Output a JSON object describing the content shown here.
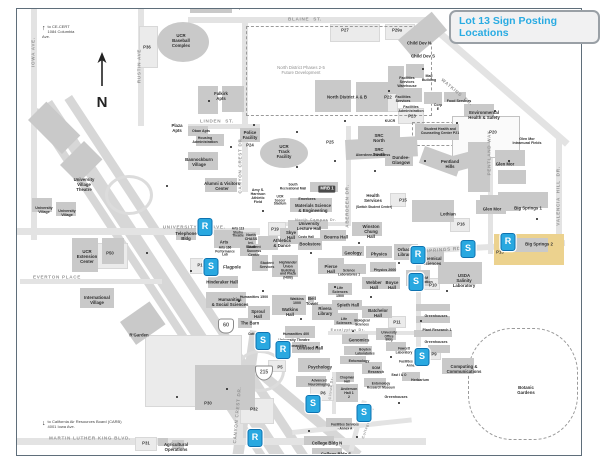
{
  "title": {
    "text": "Lot 13 Sign Posting Locations",
    "color": "#29abe2"
  },
  "map": {
    "marker_color": "#29a8e0",
    "highlight": {
      "label": "Big Springs 2",
      "color": "#ecd28e",
      "x": 494,
      "y": 234,
      "w": 70,
      "h": 31
    },
    "compass": {
      "label": "N"
    },
    "notes": [
      {
        "t": "to CE-CERT\n1084 Columbia Ave.",
        "x": 42,
        "y": 24,
        "arrow": "↑"
      },
      {
        "t": "to California Air Resources Board (CARB)\n4001 Iowa Ave.",
        "x": 42,
        "y": 419,
        "arrow": "↓"
      }
    ],
    "shields": [
      {
        "route": "60",
        "kind": "state",
        "x": 226,
        "y": 326
      },
      {
        "route": "215",
        "kind": "interstate",
        "x": 264,
        "y": 373
      }
    ],
    "streets": [
      {
        "t": "BLAINE  ST.",
        "x": 305,
        "y": 19
      },
      {
        "t": "LINDEN  ST.",
        "x": 217,
        "y": 121
      },
      {
        "t": "UNIVERSITY",
        "x": 180,
        "y": 227
      },
      {
        "t": "AVE.",
        "x": 219,
        "y": 227
      },
      {
        "t": "EVERTON PLACE",
        "x": 57,
        "y": 277
      },
      {
        "t": "MARTIN LUTHER KING BLVD.",
        "x": 90,
        "y": 438
      },
      {
        "t": "BIG SPRINGS RD",
        "x": 437,
        "y": 250,
        "rot": -4
      },
      {
        "t": "IOWA AVE.",
        "x": 33,
        "y": 52,
        "rot": -90
      },
      {
        "t": "RUSTIN AVE",
        "x": 139,
        "y": 66,
        "rot": -90
      },
      {
        "t": "CANYON CREST DR",
        "x": 240,
        "y": 166,
        "rot": -90
      },
      {
        "t": "CANYON CREST DR.",
        "x": 237,
        "y": 415,
        "rot": -85
      },
      {
        "t": "ABERDEEN DR.",
        "x": 347,
        "y": 206,
        "rot": -90
      },
      {
        "t": "WATKINS  DR.",
        "x": 457,
        "y": 92,
        "rot": 40
      },
      {
        "t": "PENTLAND WAY",
        "x": 489,
        "y": 153,
        "rot": -90
      },
      {
        "t": "VALENCIA  HILL  DR.",
        "x": 558,
        "y": 196,
        "rot": -90
      },
      {
        "t": "North Campus Dr.",
        "x": 316,
        "y": 220,
        "fs": 3.6
      },
      {
        "t": "Eucalyptus Dr.",
        "x": 348,
        "y": 330,
        "fs": 3.6
      },
      {
        "t": "Citrus Dr.",
        "x": 331,
        "y": 388,
        "rot": -85,
        "fs": 3.6
      },
      {
        "t": "College Place",
        "x": 368,
        "y": 423,
        "rot": -72,
        "fs": 3.6
      }
    ],
    "labels": [
      {
        "t": "Stonehaven Apts",
        "x": 228,
        "y": 8
      },
      {
        "t": "UCR\nBaseball\nComplex",
        "x": 181,
        "y": 41
      },
      {
        "t": "P36",
        "x": 147,
        "y": 48,
        "cls": "lot"
      },
      {
        "t": "Falkirk\nApts",
        "x": 221,
        "y": 97
      },
      {
        "t": "North District Phases 2-5\nFuture Development",
        "x": 301,
        "y": 71,
        "cls": "muted"
      },
      {
        "t": "North District A & B",
        "x": 347,
        "y": 98
      },
      {
        "t": "P27",
        "x": 345,
        "y": 31,
        "cls": "lot"
      },
      {
        "t": "P29a",
        "x": 397,
        "y": 31,
        "cls": "lot"
      },
      {
        "t": "P22",
        "x": 388,
        "y": 98,
        "cls": "lot"
      },
      {
        "t": "Child Dev N",
        "x": 419,
        "y": 44
      },
      {
        "t": "Child Dev S",
        "x": 423,
        "y": 57
      },
      {
        "t": "Facilities\nServices\nWarehouse",
        "x": 407,
        "y": 82,
        "fs": 3.6
      },
      {
        "t": "Mail\nBuilding",
        "x": 429,
        "y": 78,
        "fs": 3.6
      },
      {
        "t": "Facilities\nServices",
        "x": 403,
        "y": 99,
        "fs": 3.6
      },
      {
        "t": "Facilities\nAdministration",
        "x": 411,
        "y": 109,
        "fs": 3.6
      },
      {
        "t": "Corp\nE",
        "x": 438,
        "y": 107,
        "fs": 3.6
      },
      {
        "t": "Food Services",
        "x": 459,
        "y": 101,
        "fs": 3.6
      },
      {
        "t": "Environmental\nHealth & Safety",
        "x": 484,
        "y": 116
      },
      {
        "t": "KUCR",
        "x": 390,
        "y": 121,
        "fs": 3.6
      },
      {
        "t": "P23",
        "x": 412,
        "y": 117,
        "cls": "lot"
      },
      {
        "t": "Student Health and\nCounseling Center  P21",
        "x": 440,
        "y": 132,
        "fs": 3.5
      },
      {
        "t": "P20",
        "x": 493,
        "y": 133,
        "cls": "lot"
      },
      {
        "t": "Glen Mor\nIntramural Fields",
        "x": 527,
        "y": 141,
        "fs": 3.6
      },
      {
        "t": "Plaza\nApts",
        "x": 177,
        "y": 129
      },
      {
        "t": "Oban Apts",
        "x": 201,
        "y": 131,
        "fs": 3.6
      },
      {
        "t": "Housing\nAdministration",
        "x": 205,
        "y": 140,
        "fs": 3.6
      },
      {
        "t": "Bannockburn\nVillage",
        "x": 199,
        "y": 163
      },
      {
        "t": "Alumni & Visitors\nCenter",
        "x": 222,
        "y": 187
      },
      {
        "t": "University\nVillage\nTheatre",
        "x": 84,
        "y": 185
      },
      {
        "t": "University\nVillage",
        "x": 44,
        "y": 210,
        "fs": 3.6
      },
      {
        "t": "University\nVillage",
        "x": 67,
        "y": 213,
        "fs": 3.6
      },
      {
        "t": "Police\nFacility",
        "x": 250,
        "y": 136
      },
      {
        "t": "UCR\nTrack\nFacility",
        "x": 284,
        "y": 152
      },
      {
        "t": "P24",
        "x": 250,
        "y": 146,
        "cls": "lot"
      },
      {
        "t": "P25",
        "x": 330,
        "y": 143,
        "cls": "lot"
      },
      {
        "t": "P19",
        "x": 275,
        "y": 230,
        "cls": "lot"
      },
      {
        "t": "SRC\nNorth",
        "x": 379,
        "y": 139
      },
      {
        "t": "SRC\nSouth",
        "x": 379,
        "y": 153
      },
      {
        "t": "Aberdeen-Inverness",
        "x": 373,
        "y": 155,
        "fs": 3.6
      },
      {
        "t": "Dundee-\nGlasgow",
        "x": 401,
        "y": 161
      },
      {
        "t": "Pentland\nHills",
        "x": 450,
        "y": 165
      },
      {
        "t": "Glen Mor",
        "x": 505,
        "y": 165
      },
      {
        "t": "Glen Mor",
        "x": 492,
        "y": 210
      },
      {
        "t": "Big Springs 1",
        "x": 528,
        "y": 209
      },
      {
        "t": "Lothian",
        "x": 448,
        "y": 215
      },
      {
        "t": "P16",
        "x": 461,
        "y": 225,
        "cls": "lot"
      },
      {
        "t": "P15",
        "x": 403,
        "y": 201,
        "cls": "lot"
      },
      {
        "t": "Health\nServices",
        "x": 373,
        "y": 199
      },
      {
        "t": "(Switch Student Center)",
        "x": 374,
        "y": 208,
        "fs": 3.2
      },
      {
        "t": "Amy S.\nHarrison\nAthletic\nField",
        "x": 258,
        "y": 196,
        "fs": 3.6
      },
      {
        "t": "UCR\nSoccer\nStadium",
        "x": 280,
        "y": 201,
        "fs": 3.2
      },
      {
        "t": "South\nRecreational Mall",
        "x": 293,
        "y": 187,
        "fs": 3.2
      },
      {
        "t": "MRB 1",
        "x": 327,
        "y": 189,
        "cls": "chip"
      },
      {
        "t": "Emerbees",
        "x": 307,
        "y": 199,
        "fs": 3.6
      },
      {
        "t": "Materials Science\n& Engineering",
        "x": 313,
        "y": 209
      },
      {
        "t": "University\nLecture Hall",
        "x": 309,
        "y": 227
      },
      {
        "t": "Winston\nChung\nHall",
        "x": 371,
        "y": 232
      },
      {
        "t": "Bourns Hall",
        "x": 336,
        "y": 238
      },
      {
        "t": "Skye\nHall",
        "x": 291,
        "y": 236
      },
      {
        "t": "Costo Hall",
        "x": 306,
        "y": 238,
        "fs": 3.2
      },
      {
        "t": "Bookstore",
        "x": 310,
        "y": 245
      },
      {
        "t": "North\nCHASS\nInt.\nSouth",
        "x": 251,
        "y": 241,
        "fs": 3.6
      },
      {
        "t": "Athletics\n& Dance",
        "x": 282,
        "y": 244
      },
      {
        "t": "Student\nSuccess\nCenter",
        "x": 254,
        "y": 251,
        "fs": 3.6
      },
      {
        "t": "Student\nServices",
        "x": 267,
        "y": 265,
        "fs": 3.6
      },
      {
        "t": "Highlander\nUnion\nBuilding\nand Plaza\n(HUB)",
        "x": 288,
        "y": 271,
        "fs": 3.4
      },
      {
        "t": "Telephone\nBldg",
        "x": 186,
        "y": 237
      },
      {
        "t": "Arts",
        "x": 224,
        "y": 243
      },
      {
        "t": "Arts 166\nPerformance\nLab",
        "x": 225,
        "y": 252,
        "fs": 3.2
      },
      {
        "t": "Arts 113\nStudio\nTheatre",
        "x": 238,
        "y": 233,
        "fs": 3.2
      },
      {
        "t": "P1",
        "x": 200,
        "y": 266,
        "cls": "lot"
      },
      {
        "t": "Flagpole",
        "x": 232,
        "y": 268
      },
      {
        "t": "Hinderaker Hall",
        "x": 222,
        "y": 283
      },
      {
        "t": "Humanities\n& Social Sciences",
        "x": 230,
        "y": 303
      },
      {
        "t": "Humanities 1500",
        "x": 254,
        "y": 297,
        "fs": 3.6
      },
      {
        "t": "Sproul\nHall",
        "x": 258,
        "y": 315
      },
      {
        "t": "The Barn",
        "x": 250,
        "y": 324
      },
      {
        "t": "Watkins\n1000",
        "x": 297,
        "y": 301,
        "fs": 3.6
      },
      {
        "t": "Watkins\nHall",
        "x": 290,
        "y": 313
      },
      {
        "t": "Bell\nTower",
        "x": 312,
        "y": 302
      },
      {
        "t": "Rivera\nLibrary",
        "x": 325,
        "y": 312
      },
      {
        "t": "Life\nSciences\n1500",
        "x": 340,
        "y": 292,
        "fs": 3.6
      },
      {
        "t": "Spieth Hall",
        "x": 348,
        "y": 306
      },
      {
        "t": "Life\nSciences",
        "x": 344,
        "y": 321,
        "fs": 3.6
      },
      {
        "t": "Biological\nSciences",
        "x": 362,
        "y": 323,
        "fs": 3.2
      },
      {
        "t": "Batchelor\nHall",
        "x": 378,
        "y": 314
      },
      {
        "t": "Geology",
        "x": 353,
        "y": 254
      },
      {
        "t": "Physics",
        "x": 379,
        "y": 255
      },
      {
        "t": "Physics 2000",
        "x": 385,
        "y": 270,
        "fs": 3.6
      },
      {
        "t": "Orbach\nLibrary",
        "x": 405,
        "y": 253
      },
      {
        "t": "Pierce\nHall",
        "x": 331,
        "y": 270
      },
      {
        "t": "Science\nLaboratories 1",
        "x": 349,
        "y": 273,
        "fs": 3.2
      },
      {
        "t": "Webber\nHall",
        "x": 374,
        "y": 286
      },
      {
        "t": "Boyce\nHall",
        "x": 392,
        "y": 286
      },
      {
        "t": "SOM\nEducation",
        "x": 424,
        "y": 280,
        "fs": 3.6
      },
      {
        "t": "Chemical\nSciences",
        "x": 432,
        "y": 262
      },
      {
        "t": "USDA\nSalinity\nLaboratory",
        "x": 464,
        "y": 281
      },
      {
        "t": "P10",
        "x": 433,
        "y": 286,
        "cls": "lot"
      },
      {
        "t": "Big Springs 2",
        "x": 539,
        "y": 245
      },
      {
        "t": "P13",
        "x": 500,
        "y": 253,
        "cls": "lot"
      },
      {
        "t": "P11",
        "x": 397,
        "y": 323,
        "cls": "lot"
      },
      {
        "t": "Greenhouses",
        "x": 436,
        "y": 316,
        "fs": 3.6
      },
      {
        "t": "Plant Research 1",
        "x": 437,
        "y": 330,
        "fs": 3.6
      },
      {
        "t": "Greenhouses",
        "x": 436,
        "y": 342,
        "fs": 3.6
      },
      {
        "t": "UCR\nExtension\nCenter",
        "x": 87,
        "y": 257
      },
      {
        "t": "P50",
        "x": 110,
        "y": 254,
        "cls": "lot"
      },
      {
        "t": "International\nVillage",
        "x": 97,
        "y": 301
      },
      {
        "t": "R'Garden",
        "x": 139,
        "y": 336
      },
      {
        "t": "P30",
        "x": 208,
        "y": 404,
        "cls": "lot"
      },
      {
        "t": "P32",
        "x": 254,
        "y": 410,
        "cls": "lot"
      },
      {
        "t": "P31",
        "x": 146,
        "y": 444,
        "cls": "lot"
      },
      {
        "t": "Agricultural\nOperations",
        "x": 176,
        "y": 448
      },
      {
        "t": "Cottage",
        "x": 254,
        "y": 335,
        "fs": 3.2
      },
      {
        "t": "Humanities 400",
        "x": 296,
        "y": 334,
        "fs": 3.6
      },
      {
        "t": "University Theatre",
        "x": 294,
        "y": 340,
        "fs": 3.6
      },
      {
        "t": "Humanities",
        "x": 297,
        "y": 346,
        "fs": 3.6
      },
      {
        "t": "Olmsted Hall",
        "x": 310,
        "y": 349
      },
      {
        "t": "Psychology",
        "x": 320,
        "y": 368
      },
      {
        "t": "P5",
        "x": 280,
        "y": 368,
        "cls": "lot"
      },
      {
        "t": "P6",
        "x": 323,
        "y": 394,
        "cls": "lot"
      },
      {
        "t": "Advanced\nNeuroimaging",
        "x": 319,
        "y": 383,
        "fs": 3.2
      },
      {
        "t": "Chapman\nHall",
        "x": 347,
        "y": 380,
        "fs": 3.2
      },
      {
        "t": "Anderson\nHall  1\n2",
        "x": 349,
        "y": 393,
        "fs": 3.6
      },
      {
        "t": "Genomics",
        "x": 359,
        "y": 341
      },
      {
        "t": "Boyden\nLaboratories",
        "x": 365,
        "y": 352,
        "fs": 3.2
      },
      {
        "t": "Entomology",
        "x": 359,
        "y": 361,
        "fs": 3.6
      },
      {
        "t": "SOM\nResearch",
        "x": 376,
        "y": 370,
        "fs": 3.6
      },
      {
        "t": "East I & O",
        "x": 399,
        "y": 376,
        "fs": 3.2
      },
      {
        "t": "Entomology\nResearch Museum",
        "x": 381,
        "y": 386,
        "fs": 3.2
      },
      {
        "t": "Greenhouses",
        "x": 396,
        "y": 397,
        "fs": 3.6
      },
      {
        "t": "University\nOffice\nBldg",
        "x": 389,
        "y": 337,
        "fs": 3.2
      },
      {
        "t": "Fawcett\nLaboratory",
        "x": 404,
        "y": 351,
        "fs": 3.2
      },
      {
        "t": "Facilities Services\n- Annex A",
        "x": 345,
        "y": 427,
        "fs": 3.2
      },
      {
        "t": "Facilities Services\nAnnex B",
        "x": 413,
        "y": 364,
        "fs": 3.2
      },
      {
        "t": "College Bldg N",
        "x": 327,
        "y": 444
      },
      {
        "t": "College Bldg S",
        "x": 336,
        "y": 455
      },
      {
        "t": "Herbarium",
        "x": 420,
        "y": 380,
        "fs": 3.6
      },
      {
        "t": "Computing &\nCommunications",
        "x": 464,
        "y": 370
      },
      {
        "t": "P9",
        "x": 434,
        "y": 355,
        "cls": "lot"
      },
      {
        "t": "Botanic\nGardens",
        "x": 526,
        "y": 391
      }
    ],
    "markers": [
      {
        "letter": "R",
        "x": 205,
        "y": 227
      },
      {
        "letter": "S",
        "x": 211,
        "y": 267
      },
      {
        "letter": "R",
        "x": 418,
        "y": 255
      },
      {
        "letter": "S",
        "x": 468,
        "y": 249
      },
      {
        "letter": "R",
        "x": 508,
        "y": 242
      },
      {
        "letter": "S",
        "x": 416,
        "y": 282
      },
      {
        "letter": "S",
        "x": 263,
        "y": 341
      },
      {
        "letter": "R",
        "x": 283,
        "y": 350
      },
      {
        "letter": "S",
        "x": 313,
        "y": 404
      },
      {
        "letter": "S",
        "x": 364,
        "y": 413
      },
      {
        "letter": "S",
        "x": 422,
        "y": 357
      },
      {
        "letter": "R",
        "x": 255,
        "y": 438
      }
    ]
  }
}
